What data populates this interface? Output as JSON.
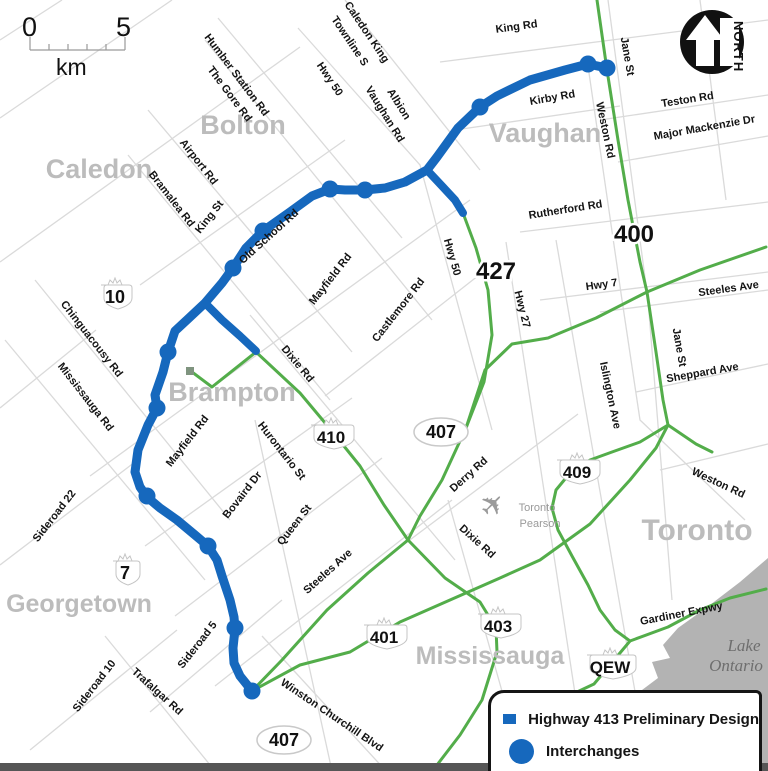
{
  "scale_bar": {
    "start_label": "0",
    "end_label": "5",
    "unit": "km"
  },
  "north_arrow": {
    "label": "NORTH"
  },
  "legend": {
    "items": [
      {
        "swatch": "line",
        "label": "Highway 413 Preliminary Design"
      },
      {
        "swatch": "dot",
        "label": "Interchanges"
      }
    ]
  },
  "colors": {
    "route": "#1668bd",
    "highway_green": "#53ad4a",
    "minor_road": "#dadada",
    "lake": "#b3b3b3",
    "city_text": "#bcbcbc"
  },
  "route413": {
    "width": 9,
    "main": [
      [
        607,
        68
      ],
      [
        588,
        64
      ],
      [
        565,
        70
      ],
      [
        530,
        80
      ],
      [
        497,
        96
      ],
      [
        480,
        107
      ],
      [
        458,
        128
      ],
      [
        437,
        157
      ],
      [
        427,
        170
      ],
      [
        405,
        182
      ],
      [
        385,
        188
      ],
      [
        365,
        190
      ],
      [
        345,
        190
      ],
      [
        330,
        189
      ],
      [
        312,
        196
      ],
      [
        290,
        212
      ],
      [
        263,
        231
      ],
      [
        246,
        248
      ],
      [
        233,
        268
      ],
      [
        222,
        283
      ],
      [
        205,
        303
      ],
      [
        189,
        318
      ],
      [
        175,
        331
      ],
      [
        168,
        352
      ],
      [
        163,
        372
      ],
      [
        155,
        395
      ],
      [
        157,
        408
      ],
      [
        148,
        425
      ],
      [
        138,
        450
      ],
      [
        135,
        472
      ],
      [
        140,
        487
      ],
      [
        147,
        497
      ],
      [
        160,
        508
      ],
      [
        177,
        520
      ],
      [
        195,
        535
      ],
      [
        208,
        546
      ],
      [
        217,
        560
      ],
      [
        222,
        576
      ],
      [
        230,
        600
      ],
      [
        234,
        617
      ],
      [
        235,
        629
      ],
      [
        233,
        648
      ],
      [
        234,
        663
      ],
      [
        240,
        676
      ],
      [
        252,
        691
      ]
    ],
    "spurs": [
      [
        [
          427,
          170
        ],
        [
          442,
          186
        ],
        [
          455,
          200
        ],
        [
          463,
          213
        ]
      ],
      [
        [
          205,
          303
        ],
        [
          222,
          320
        ],
        [
          240,
          336
        ],
        [
          256,
          351
        ]
      ]
    ],
    "interchanges": [
      [
        607,
        68
      ],
      [
        588,
        64
      ],
      [
        480,
        107
      ],
      [
        365,
        190
      ],
      [
        330,
        189
      ],
      [
        263,
        231
      ],
      [
        233,
        268
      ],
      [
        168,
        352
      ],
      [
        157,
        408
      ],
      [
        147,
        496
      ],
      [
        208,
        546
      ],
      [
        235,
        628
      ],
      [
        252,
        691
      ]
    ],
    "dot_radius": 8.5
  },
  "green_highways": {
    "width": 3,
    "terminus_marker": [
      186,
      367
    ],
    "lines": [
      [
        [
          597,
          0
        ],
        [
          607,
          70
        ],
        [
          618,
          140
        ],
        [
          628,
          200
        ],
        [
          640,
          262
        ],
        [
          647,
          292
        ],
        [
          656,
          352
        ],
        [
          663,
          400
        ],
        [
          668,
          425
        ]
      ],
      [
        [
          252,
          691
        ],
        [
          300,
          665
        ],
        [
          350,
          652
        ],
        [
          400,
          622
        ],
        [
          450,
          600
        ],
        [
          500,
          578
        ],
        [
          540,
          560
        ],
        [
          590,
          524
        ],
        [
          630,
          480
        ],
        [
          656,
          448
        ],
        [
          668,
          425
        ],
        [
          696,
          444
        ],
        [
          712,
          452
        ]
      ],
      [
        [
          252,
          691
        ],
        [
          282,
          660
        ],
        [
          327,
          610
        ],
        [
          368,
          573
        ],
        [
          408,
          540
        ]
      ],
      [
        [
          192,
          372
        ],
        [
          212,
          387
        ],
        [
          256,
          352
        ],
        [
          300,
          393
        ],
        [
          331,
          430
        ],
        [
          360,
          466
        ],
        [
          384,
          505
        ],
        [
          408,
          540
        ]
      ],
      [
        [
          463,
          213
        ],
        [
          476,
          248
        ],
        [
          488,
          290
        ],
        [
          492,
          335
        ],
        [
          484,
          382
        ],
        [
          466,
          428
        ],
        [
          442,
          480
        ],
        [
          420,
          516
        ],
        [
          408,
          540
        ]
      ],
      [
        [
          408,
          540
        ],
        [
          445,
          578
        ],
        [
          480,
          602
        ],
        [
          496,
          628
        ],
        [
          497,
          652
        ],
        [
          482,
          700
        ],
        [
          460,
          735
        ],
        [
          437,
          765
        ]
      ],
      [
        [
          668,
          425
        ],
        [
          640,
          442
        ],
        [
          612,
          452
        ],
        [
          590,
          460
        ],
        [
          570,
          473
        ],
        [
          556,
          490
        ],
        [
          552,
          508
        ],
        [
          558,
          530
        ],
        [
          572,
          556
        ],
        [
          588,
          585
        ],
        [
          600,
          610
        ],
        [
          615,
          630
        ],
        [
          630,
          641
        ]
      ],
      [
        [
          500,
          762
        ],
        [
          530,
          728
        ],
        [
          560,
          700
        ],
        [
          594,
          684
        ],
        [
          630,
          641
        ],
        [
          668,
          627
        ],
        [
          700,
          610
        ],
        [
          730,
          598
        ],
        [
          766,
          589
        ]
      ],
      [
        [
          766,
          247
        ],
        [
          700,
          270
        ],
        [
          647,
          292
        ],
        [
          596,
          318
        ],
        [
          548,
          338
        ],
        [
          512,
          344
        ],
        [
          485,
          370
        ],
        [
          466,
          428
        ]
      ]
    ]
  },
  "minor_roads": {
    "width": 1.3,
    "lines": [
      [
        [
          0,
          118
        ],
        [
          172,
          0
        ]
      ],
      [
        [
          0,
          262
        ],
        [
          300,
          47
        ]
      ],
      [
        [
          140,
          285
        ],
        [
          345,
          140
        ]
      ],
      [
        [
          90,
          476
        ],
        [
          470,
          200
        ]
      ],
      [
        [
          325,
          396
        ],
        [
          488,
          268
        ]
      ],
      [
        [
          145,
          546
        ],
        [
          352,
          398
        ]
      ],
      [
        [
          175,
          616
        ],
        [
          382,
          458
        ]
      ],
      [
        [
          215,
          686
        ],
        [
          452,
          500
        ]
      ],
      [
        [
          375,
          566
        ],
        [
          578,
          414
        ]
      ],
      [
        [
          0,
          565
        ],
        [
          135,
          462
        ]
      ],
      [
        [
          30,
          750
        ],
        [
          177,
          630
        ]
      ],
      [
        [
          150,
          712
        ],
        [
          282,
          600
        ]
      ],
      [
        [
          105,
          636
        ],
        [
          215,
          771
        ]
      ],
      [
        [
          262,
          636
        ],
        [
          386,
          771
        ]
      ],
      [
        [
          250,
          315
        ],
        [
          455,
          560
        ]
      ],
      [
        [
          5,
          340
        ],
        [
          205,
          580
        ]
      ],
      [
        [
          35,
          280
        ],
        [
          230,
          520
        ]
      ],
      [
        [
          128,
          155
        ],
        [
          330,
          400
        ]
      ],
      [
        [
          148,
          110
        ],
        [
          352,
          352
        ]
      ],
      [
        [
          205,
          40
        ],
        [
          432,
          320
        ]
      ],
      [
        [
          218,
          18
        ],
        [
          402,
          238
        ]
      ],
      [
        [
          298,
          28
        ],
        [
          420,
          165
        ],
        [
          492,
          430
        ]
      ],
      [
        [
          345,
          0
        ],
        [
          480,
          170
        ]
      ],
      [
        [
          440,
          62
        ],
        [
          768,
          20
        ]
      ],
      [
        [
          455,
          130
        ],
        [
          620,
          106
        ]
      ],
      [
        [
          600,
          120
        ],
        [
          768,
          95
        ]
      ],
      [
        [
          618,
          162
        ],
        [
          768,
          136
        ]
      ],
      [
        [
          520,
          232
        ],
        [
          768,
          202
        ]
      ],
      [
        [
          540,
          300
        ],
        [
          768,
          272
        ]
      ],
      [
        [
          600,
          312
        ],
        [
          768,
          290
        ]
      ],
      [
        [
          636,
          392
        ],
        [
          768,
          364
        ]
      ],
      [
        [
          608,
          0
        ],
        [
          648,
          300
        ],
        [
          672,
          600
        ]
      ],
      [
        [
          588,
          66
        ],
        [
          622,
          300
        ],
        [
          640,
          420
        ],
        [
          745,
          520
        ]
      ],
      [
        [
          556,
          240
        ],
        [
          640,
          720
        ]
      ],
      [
        [
          506,
          242
        ],
        [
          576,
          700
        ]
      ],
      [
        [
          255,
          420
        ],
        [
          332,
          771
        ]
      ],
      [
        [
          448,
          500
        ],
        [
          522,
          762
        ]
      ],
      [
        [
          0,
          40
        ],
        [
          62,
          0
        ]
      ],
      [
        [
          0,
          408
        ],
        [
          96,
          330
        ]
      ],
      [
        [
          660,
          470
        ],
        [
          768,
          444
        ]
      ],
      [
        [
          700,
          0
        ],
        [
          726,
          200
        ]
      ]
    ]
  },
  "lake": {
    "points": [
      [
        768,
        558
      ],
      [
        740,
        582
      ],
      [
        706,
        608
      ],
      [
        678,
        628
      ],
      [
        663,
        645
      ],
      [
        670,
        658
      ],
      [
        652,
        662
      ],
      [
        658,
        678
      ],
      [
        642,
        690
      ],
      [
        652,
        702
      ],
      [
        636,
        716
      ],
      [
        648,
        730
      ],
      [
        632,
        746
      ],
      [
        642,
        760
      ],
      [
        634,
        771
      ],
      [
        768,
        771
      ]
    ],
    "labels": [
      {
        "text": "Lake",
        "x": 744,
        "y": 651
      },
      {
        "text": "Ontario",
        "x": 736,
        "y": 671
      }
    ]
  },
  "cities": [
    {
      "text": "Caledon",
      "x": 99,
      "y": 178,
      "size": 27
    },
    {
      "text": "Bolton",
      "x": 243,
      "y": 134,
      "size": 27
    },
    {
      "text": "Vaughan",
      "x": 545,
      "y": 142,
      "size": 27
    },
    {
      "text": "Brampton",
      "x": 232,
      "y": 401,
      "size": 27
    },
    {
      "text": "Georgetown",
      "x": 79,
      "y": 612,
      "size": 25
    },
    {
      "text": "Mississauga",
      "x": 490,
      "y": 664,
      "size": 25
    },
    {
      "text": "Toronto",
      "x": 697,
      "y": 540,
      "size": 30
    }
  ],
  "road_labels": [
    {
      "text": "Humber Station Rd",
      "x": 234,
      "y": 77,
      "rot": 53
    },
    {
      "text": "The Gore Rd",
      "x": 227,
      "y": 96,
      "rot": 53
    },
    {
      "text": "Hwy 50",
      "x": 327,
      "y": 81,
      "rot": 56
    },
    {
      "text": "Caledon King",
      "x": 364,
      "y": 34,
      "rot": 56
    },
    {
      "text": "Townline S",
      "x": 347,
      "y": 43,
      "rot": 56
    },
    {
      "text": "Albion",
      "x": 396,
      "y": 106,
      "rot": 58
    },
    {
      "text": "Vaughan Rd",
      "x": 382,
      "y": 116,
      "rot": 58
    },
    {
      "text": "King Rd",
      "x": 517,
      "y": 30,
      "rot": -8
    },
    {
      "text": "Jane St",
      "x": 624,
      "y": 57,
      "rot": 80
    },
    {
      "text": "Kirby Rd",
      "x": 553,
      "y": 101,
      "rot": -10
    },
    {
      "text": "Weston Rd",
      "x": 602,
      "y": 131,
      "rot": 78
    },
    {
      "text": "Teston Rd",
      "x": 688,
      "y": 103,
      "rot": -9
    },
    {
      "text": "Major Mackenzie Dr",
      "x": 705,
      "y": 131,
      "rot": -10
    },
    {
      "text": "Rutherford Rd",
      "x": 566,
      "y": 213,
      "rot": -9
    },
    {
      "text": "Hwy 7",
      "x": 602,
      "y": 288,
      "rot": -8
    },
    {
      "text": "Steeles Ave",
      "x": 729,
      "y": 292,
      "rot": -8
    },
    {
      "text": "Hwy 27",
      "x": 519,
      "y": 310,
      "rot": 76
    },
    {
      "text": "Jane St",
      "x": 676,
      "y": 348,
      "rot": 80
    },
    {
      "text": "Sheppard Ave",
      "x": 703,
      "y": 376,
      "rot": -10
    },
    {
      "text": "Islington Ave",
      "x": 607,
      "y": 396,
      "rot": 78
    },
    {
      "text": "Weston  Rd",
      "x": 717,
      "y": 486,
      "rot": 25
    },
    {
      "text": "Old School Rd",
      "x": 271,
      "y": 239,
      "rot": -42
    },
    {
      "text": "Mayfield Rd",
      "x": 333,
      "y": 281,
      "rot": -52
    },
    {
      "text": "Castlemore Rd",
      "x": 401,
      "y": 312,
      "rot": -52
    },
    {
      "text": "Hwy 50",
      "x": 449,
      "y": 258,
      "rot": 74
    },
    {
      "text": "Dixie Rd",
      "x": 295,
      "y": 366,
      "rot": 50
    },
    {
      "text": "Chinguacousy Rd",
      "x": 89,
      "y": 341,
      "rot": 52
    },
    {
      "text": "Mississauga Rd",
      "x": 83,
      "y": 399,
      "rot": 52
    },
    {
      "text": "King St",
      "x": 212,
      "y": 219,
      "rot": -52
    },
    {
      "text": "Airport Rd",
      "x": 196,
      "y": 164,
      "rot": 52
    },
    {
      "text": "Bramalea Rd",
      "x": 169,
      "y": 201,
      "rot": 52
    },
    {
      "text": "Sideroad 22",
      "x": 57,
      "y": 518,
      "rot": -52
    },
    {
      "text": "Mayfield Rd",
      "x": 190,
      "y": 443,
      "rot": -52
    },
    {
      "text": "Hurontario St",
      "x": 279,
      "y": 453,
      "rot": 52
    },
    {
      "text": "Bovaird Dr",
      "x": 245,
      "y": 497,
      "rot": -52
    },
    {
      "text": "Queen St",
      "x": 297,
      "y": 527,
      "rot": -52
    },
    {
      "text": "Steeles Ave",
      "x": 330,
      "y": 574,
      "rot": -42
    },
    {
      "text": "Derry Rd",
      "x": 471,
      "y": 477,
      "rot": -42
    },
    {
      "text": "Dixie Rd",
      "x": 475,
      "y": 544,
      "rot": 42
    },
    {
      "text": "Sideroad 5",
      "x": 200,
      "y": 647,
      "rot": -52
    },
    {
      "text": "Sideroad 10",
      "x": 97,
      "y": 688,
      "rot": -52
    },
    {
      "text": "Trafalgar Rd",
      "x": 155,
      "y": 694,
      "rot": 42
    },
    {
      "text": "Winston Churchill Blvd",
      "x": 330,
      "y": 718,
      "rot": 34
    },
    {
      "text": "Gardiner Expwy",
      "x": 682,
      "y": 617,
      "rot": -11
    }
  ],
  "shields": [
    {
      "text": "10",
      "x": 115,
      "y": 297,
      "type": "crown",
      "w": 34
    },
    {
      "text": "7",
      "x": 125,
      "y": 573,
      "type": "crown",
      "w": 30
    },
    {
      "text": "410",
      "x": 331,
      "y": 437,
      "type": "crown",
      "w": 46
    },
    {
      "text": "427",
      "x": 496,
      "y": 271,
      "type": "halo"
    },
    {
      "text": "400",
      "x": 634,
      "y": 234,
      "type": "halo"
    },
    {
      "text": "407",
      "x": 441,
      "y": 432,
      "type": "oval"
    },
    {
      "text": "409",
      "x": 577,
      "y": 472,
      "type": "crown",
      "w": 46
    },
    {
      "text": "401",
      "x": 384,
      "y": 637,
      "type": "crown",
      "w": 46
    },
    {
      "text": "403",
      "x": 498,
      "y": 626,
      "type": "crown",
      "w": 46
    },
    {
      "text": "407",
      "x": 284,
      "y": 740,
      "type": "oval"
    },
    {
      "text": "QEW",
      "x": 610,
      "y": 667,
      "type": "crown",
      "w": 52
    }
  ],
  "airport": {
    "x": 500,
    "y": 512,
    "labels": [
      {
        "text": "Toronto",
        "x": 537,
        "y": 511
      },
      {
        "text": "Pearson",
        "x": 540,
        "y": 527
      }
    ]
  }
}
